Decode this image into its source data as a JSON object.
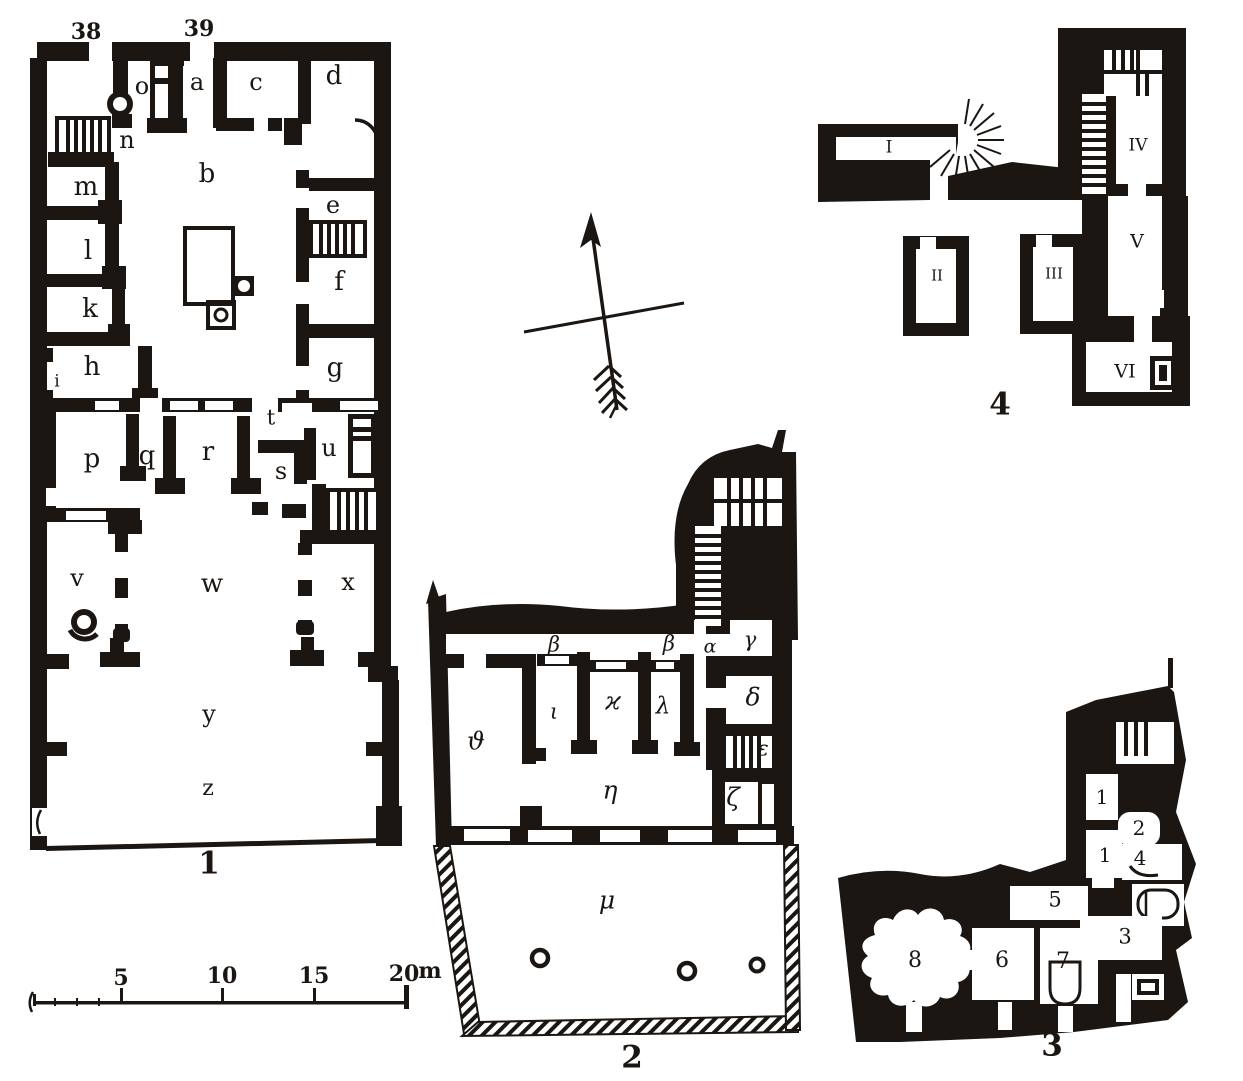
{
  "colors": {
    "ink": "#1b1612",
    "paper": "#ffffff"
  },
  "plan1": {
    "number": "1",
    "entrances": {
      "n38": "38",
      "n39": "39"
    },
    "rooms": {
      "a": "a",
      "b": "b",
      "c": "c",
      "d": "d",
      "e": "e",
      "f": "f",
      "g": "g",
      "h": "h",
      "i": "i",
      "k": "k",
      "l": "l",
      "m": "m",
      "n": "n",
      "o": "o",
      "p": "p",
      "q": "q",
      "r": "r",
      "s": "s",
      "t": "t",
      "u": "u",
      "v": "v",
      "w": "w",
      "x": "x",
      "y": "y",
      "z": "z"
    }
  },
  "plan2": {
    "number": "2",
    "rooms": {
      "alpha": "α",
      "beta_a": "β",
      "beta_b": "β",
      "gamma": "γ",
      "delta": "δ",
      "epsilon": "ε",
      "zeta": "ζ",
      "eta": "η",
      "theta": "ϑ",
      "iota": "ι",
      "kappa": "ϰ",
      "lambda": "λ",
      "mu": "μ"
    }
  },
  "plan3": {
    "number": "3",
    "rooms": {
      "one_a": "1",
      "two": "2",
      "one_b": "1",
      "four": "4",
      "five": "5",
      "three": "3",
      "six": "6",
      "seven": "7",
      "eight": "8"
    }
  },
  "plan4": {
    "number": "4",
    "rooms": {
      "i": "I",
      "ii": "II",
      "iii": "III",
      "iv": "IV",
      "v": "V",
      "vi": "VI"
    }
  },
  "scale_bar": {
    "t5": "5",
    "t10": "10",
    "t15": "15",
    "t20": "20",
    "unit": "m"
  },
  "compass": {
    "icon": "north-arrow"
  }
}
